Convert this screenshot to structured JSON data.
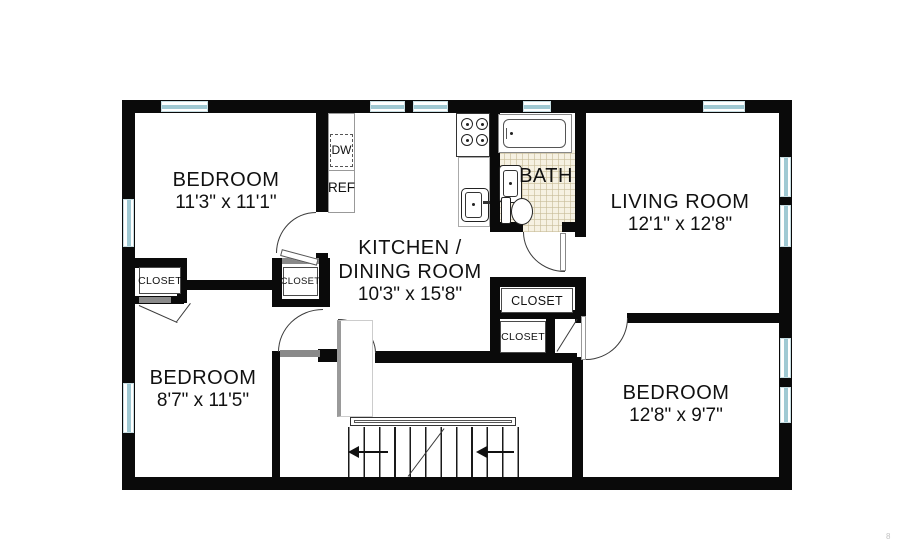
{
  "plan": {
    "bedroom_tl": {
      "name": "BEDROOM",
      "dims": "11'3\" x 11'1\""
    },
    "bedroom_bl": {
      "name": "BEDROOM",
      "dims": "8'7\" x 11'5\""
    },
    "bedroom_br": {
      "name": "BEDROOM",
      "dims": "12'8\" x 9'7\""
    },
    "kitchen_dining": {
      "name_line1": "KITCHEN /",
      "name_line2": "DINING ROOM",
      "dims": "10'3\" x 15'8\""
    },
    "living_room": {
      "name": "LIVING ROOM",
      "dims": "12'1\" x 12'8\""
    },
    "bath": {
      "name": "BATH"
    },
    "closet_label": "CLOSET",
    "appliances": {
      "dishwasher": "DW",
      "refrigerator": "REF"
    },
    "colors": {
      "wall": "#0a0a0a",
      "window_glass": "#9fc9d3",
      "bath_tile": "#f6f1e2"
    },
    "page_mark": "8"
  }
}
